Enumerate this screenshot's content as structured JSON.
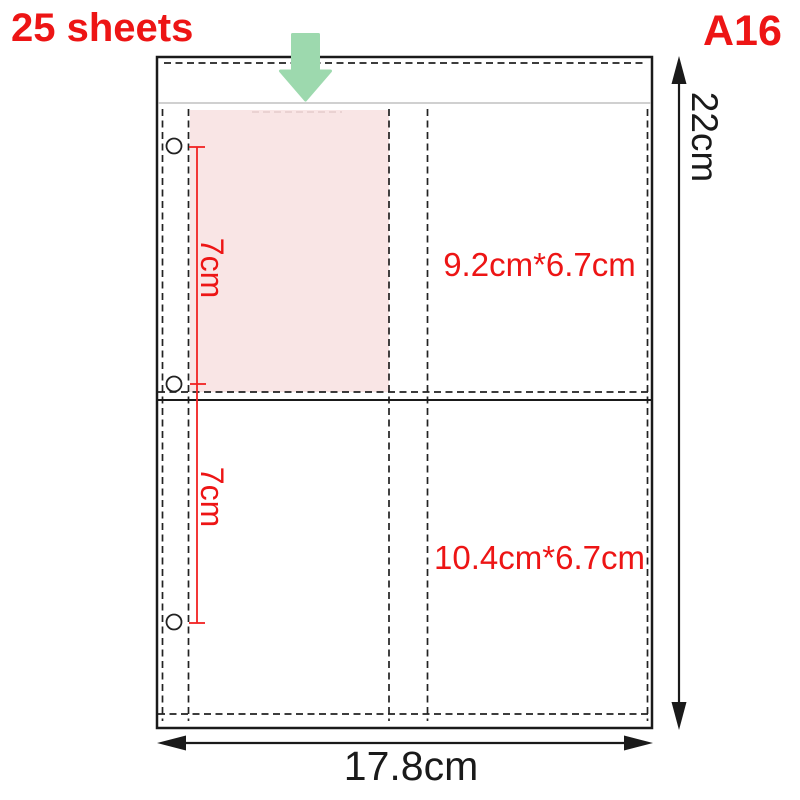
{
  "header": {
    "sheets_label": "25 sheets",
    "model_label": "A16"
  },
  "page": {
    "height_label": "22cm",
    "width_label": "17.8cm",
    "top_pocket_label": "9.2cm*6.7cm",
    "bottom_pocket_label": "10.4cm*6.7cm",
    "top_insert_label": "7cm",
    "bottom_insert_label": "7cm"
  },
  "icons": {
    "down_arrow": "insert-direction-down-arrow"
  },
  "colors": {
    "accent_red": "#ed1515",
    "measure_red": "#f22222",
    "arrow_green": "#9dd9ae",
    "insert_pink": "#f9e5e5",
    "line_black": "#1a1a1a",
    "seam_gray": "#b3b3b3"
  }
}
